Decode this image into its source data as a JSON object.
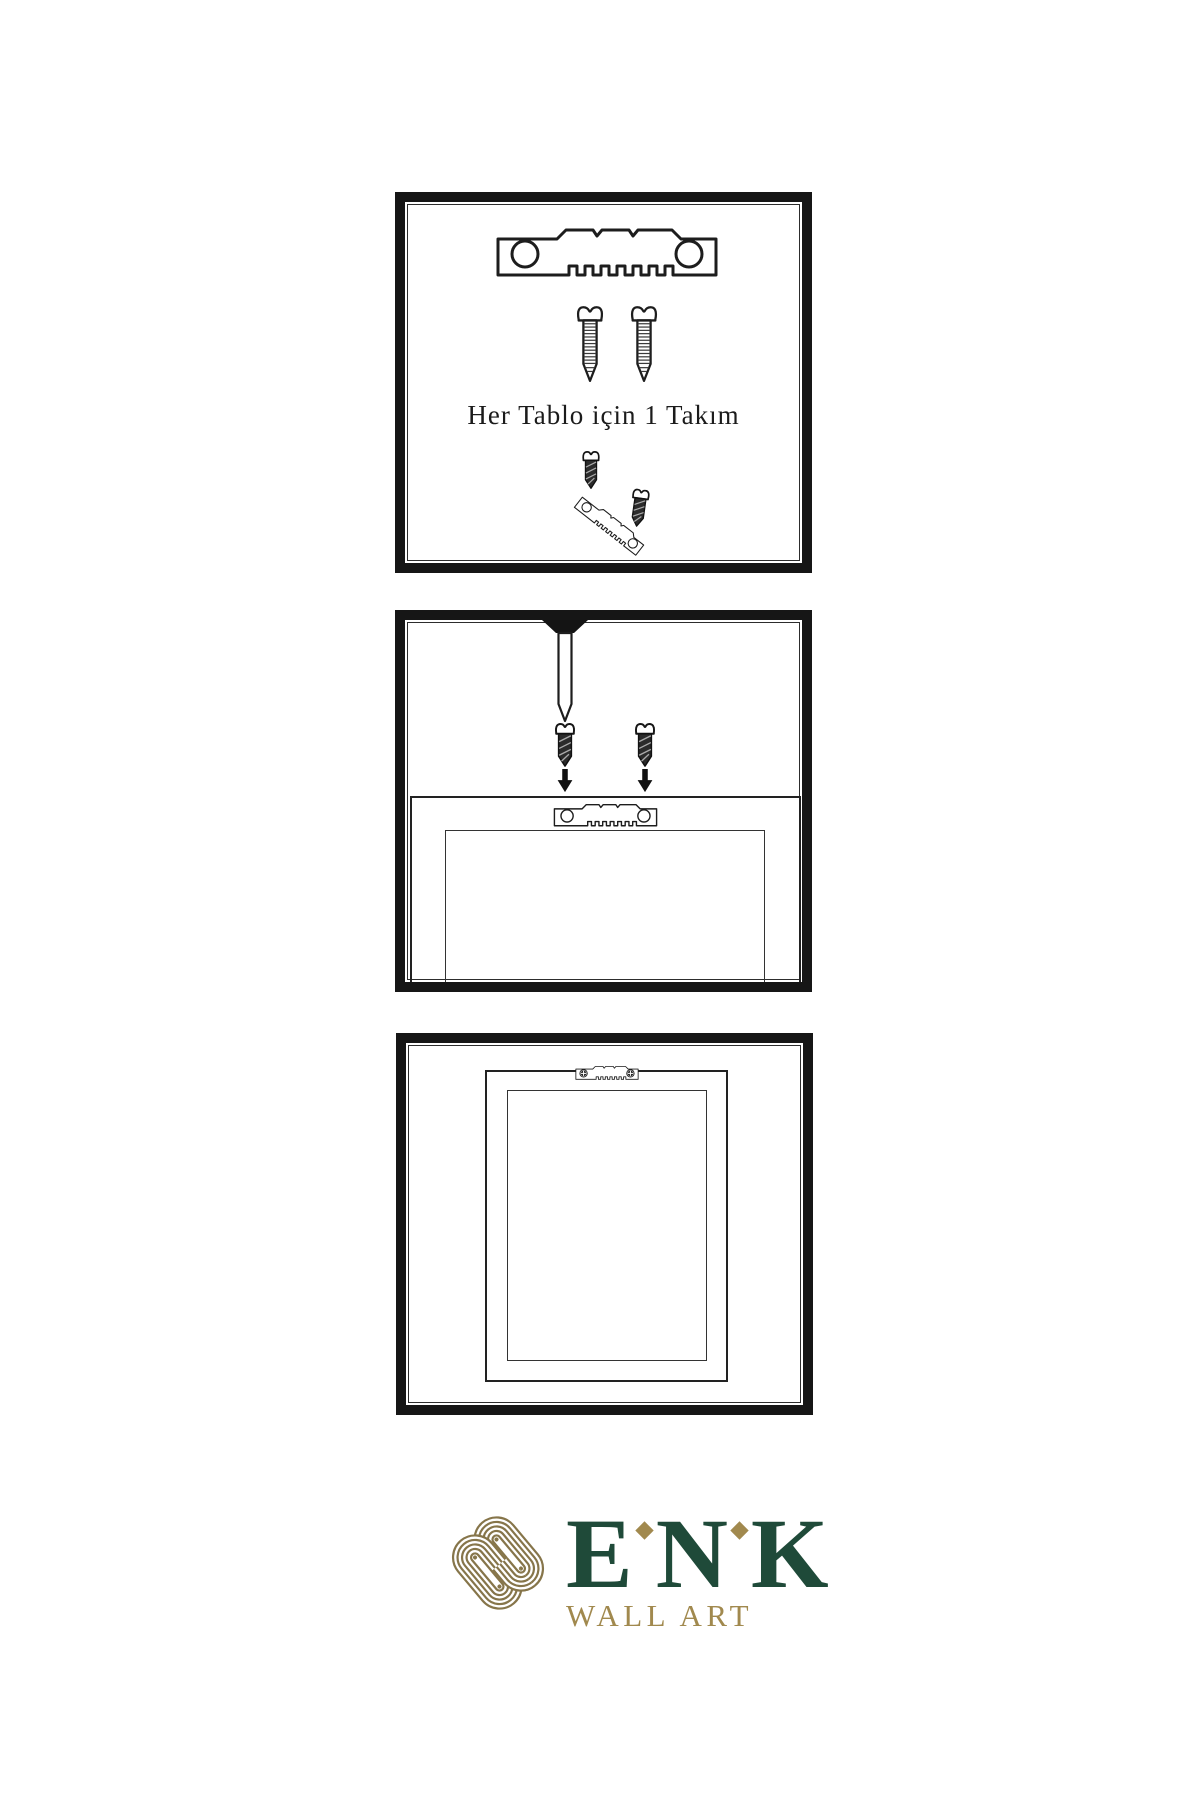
{
  "sheet": {
    "background": "#ffffff",
    "line_color": "#1d1d1d",
    "caption": "Her Tablo için 1 Takım",
    "panels": [
      {
        "name": "hardware-kit",
        "description_icons": [
          "sawtooth-hanger-icon",
          "screw-icon",
          "screw-icon",
          "screw-into-hanger-assembly-icon"
        ]
      },
      {
        "name": "mounting-step",
        "description_icons": [
          "nail-icon",
          "dark-screw-icon",
          "dark-screw-icon",
          "arrow-down-icon",
          "arrow-down-icon",
          "sawtooth-hanger-icon",
          "frame-back-outline"
        ]
      },
      {
        "name": "hanging-result",
        "description_icons": [
          "sawtooth-hanger-with-screws-icon",
          "frame-outline"
        ]
      }
    ]
  },
  "icons": {
    "sawtooth-hanger": "metal sawtooth picture hanger plate with two round holes",
    "screw": "threaded mounting screw",
    "dark-screw": "short dark screw",
    "arrow-down": "downward arrow",
    "nail": "wall nail",
    "knot": "interlaced knot brand mark"
  },
  "logo": {
    "letters": [
      "E",
      "N",
      "K"
    ],
    "brand": "ENK",
    "subtitle": "WALL ART",
    "brand_color": "#1F4A39",
    "gold_color": "#A1894E",
    "knot_color": "#86754A"
  }
}
